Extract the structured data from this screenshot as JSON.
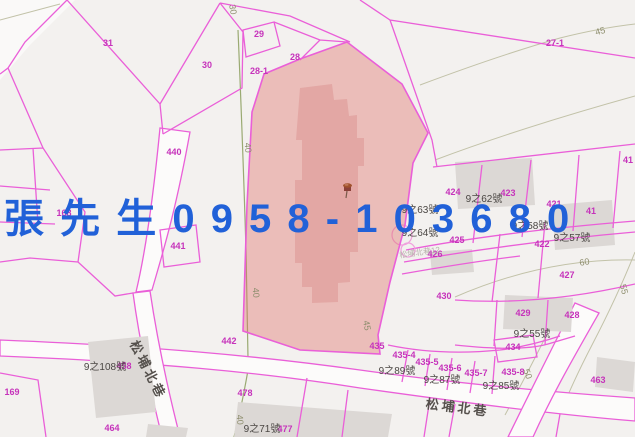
{
  "overlay": {
    "text": "張 先 生 0 9 5 8 - 1 0 3 6 8 0",
    "color": "#2161d8"
  },
  "map": {
    "colors": {
      "background": "#f3f1ef",
      "parcel_line": "#ea5fd8",
      "parcel_label": "#c633bb",
      "highlight_fill": "rgba(222,112,106,0.40)",
      "highlight_building": "rgba(195,80,80,0.20)",
      "building_fill": "#dcd8d5",
      "road_fill": "#fcfbfa",
      "contour": "#c2c2a8",
      "contour_green": "#9aaa72"
    },
    "marker": {
      "x": 347,
      "y": 190,
      "kind": "red-pushpin"
    },
    "parcel_labels": [
      {
        "text": "31",
        "x": 108,
        "y": 46
      },
      {
        "text": "30",
        "x": 207,
        "y": 68
      },
      {
        "text": "29",
        "x": 259,
        "y": 37
      },
      {
        "text": "28",
        "x": 295,
        "y": 60
      },
      {
        "text": "28-1",
        "x": 259,
        "y": 74
      },
      {
        "text": "27-1",
        "x": 555,
        "y": 46
      },
      {
        "text": "440",
        "x": 174,
        "y": 155
      },
      {
        "text": "168",
        "x": 64,
        "y": 216
      },
      {
        "text": "441",
        "x": 178,
        "y": 249
      },
      {
        "text": "424",
        "x": 453,
        "y": 195
      },
      {
        "text": "423",
        "x": 508,
        "y": 196
      },
      {
        "text": "421",
        "x": 554,
        "y": 207
      },
      {
        "text": "41",
        "x": 628,
        "y": 163
      },
      {
        "text": "41",
        "x": 591,
        "y": 214
      },
      {
        "text": "425",
        "x": 457,
        "y": 243
      },
      {
        "text": "426",
        "x": 435,
        "y": 257
      },
      {
        "text": "422",
        "x": 542,
        "y": 247
      },
      {
        "text": "427",
        "x": 567,
        "y": 278
      },
      {
        "text": "430",
        "x": 444,
        "y": 299
      },
      {
        "text": "429",
        "x": 523,
        "y": 316
      },
      {
        "text": "428",
        "x": 572,
        "y": 318
      },
      {
        "text": "434",
        "x": 513,
        "y": 350
      },
      {
        "text": "435",
        "x": 377,
        "y": 349
      },
      {
        "text": "435-4",
        "x": 404,
        "y": 358
      },
      {
        "text": "435-5",
        "x": 427,
        "y": 365
      },
      {
        "text": "435-6",
        "x": 450,
        "y": 371
      },
      {
        "text": "435-7",
        "x": 476,
        "y": 376
      },
      {
        "text": "435-8",
        "x": 513,
        "y": 375
      },
      {
        "text": "463",
        "x": 598,
        "y": 383
      },
      {
        "text": "442",
        "x": 229,
        "y": 344
      },
      {
        "text": "478",
        "x": 245,
        "y": 396
      },
      {
        "text": "169",
        "x": 12,
        "y": 395
      },
      {
        "text": "458",
        "x": 124,
        "y": 369
      },
      {
        "text": "464",
        "x": 112,
        "y": 431
      },
      {
        "text": "477",
        "x": 285,
        "y": 432
      }
    ],
    "house_labels": [
      {
        "text": "9之63號",
        "x": 420,
        "y": 213
      },
      {
        "text": "9之62號",
        "x": 484,
        "y": 202
      },
      {
        "text": "9之64號",
        "x": 420,
        "y": 236
      },
      {
        "text": "9之58號",
        "x": 530,
        "y": 229
      },
      {
        "text": "9之57號",
        "x": 572,
        "y": 241
      },
      {
        "text": "9之55號",
        "x": 532,
        "y": 337
      },
      {
        "text": "9之89號",
        "x": 397,
        "y": 374
      },
      {
        "text": "9之87號",
        "x": 442,
        "y": 383
      },
      {
        "text": "9之85號",
        "x": 501,
        "y": 389
      },
      {
        "text": "9之108號",
        "x": 105,
        "y": 370
      },
      {
        "text": "9之71號",
        "x": 262,
        "y": 432
      }
    ],
    "road_labels": [
      {
        "text": "松埔北巷",
        "x": 457,
        "y": 412,
        "rot": 7
      },
      {
        "text": "松埔北巷",
        "x": 144,
        "y": 372,
        "rot": 63
      }
    ],
    "contour_labels": [
      {
        "text": "45",
        "x": 601,
        "y": 34,
        "rot": -15
      },
      {
        "text": "45",
        "x": 364,
        "y": 326,
        "rot": 80
      },
      {
        "text": "60",
        "x": 585,
        "y": 265,
        "rot": -10
      },
      {
        "text": "55",
        "x": 621,
        "y": 290,
        "rot": 75
      },
      {
        "text": "50",
        "x": 525,
        "y": 375,
        "rot": 70
      },
      {
        "text": "40",
        "x": 245,
        "y": 148,
        "rot": 85
      },
      {
        "text": "40",
        "x": 253,
        "y": 293,
        "rot": 85
      },
      {
        "text": "40",
        "x": 237,
        "y": 420,
        "rot": 85
      },
      {
        "text": "30",
        "x": 230,
        "y": 10,
        "rot": 80
      }
    ],
    "faint_labels": [
      {
        "text": "松埔北巷12",
        "x": 420,
        "y": 255,
        "rot": -8
      }
    ]
  }
}
